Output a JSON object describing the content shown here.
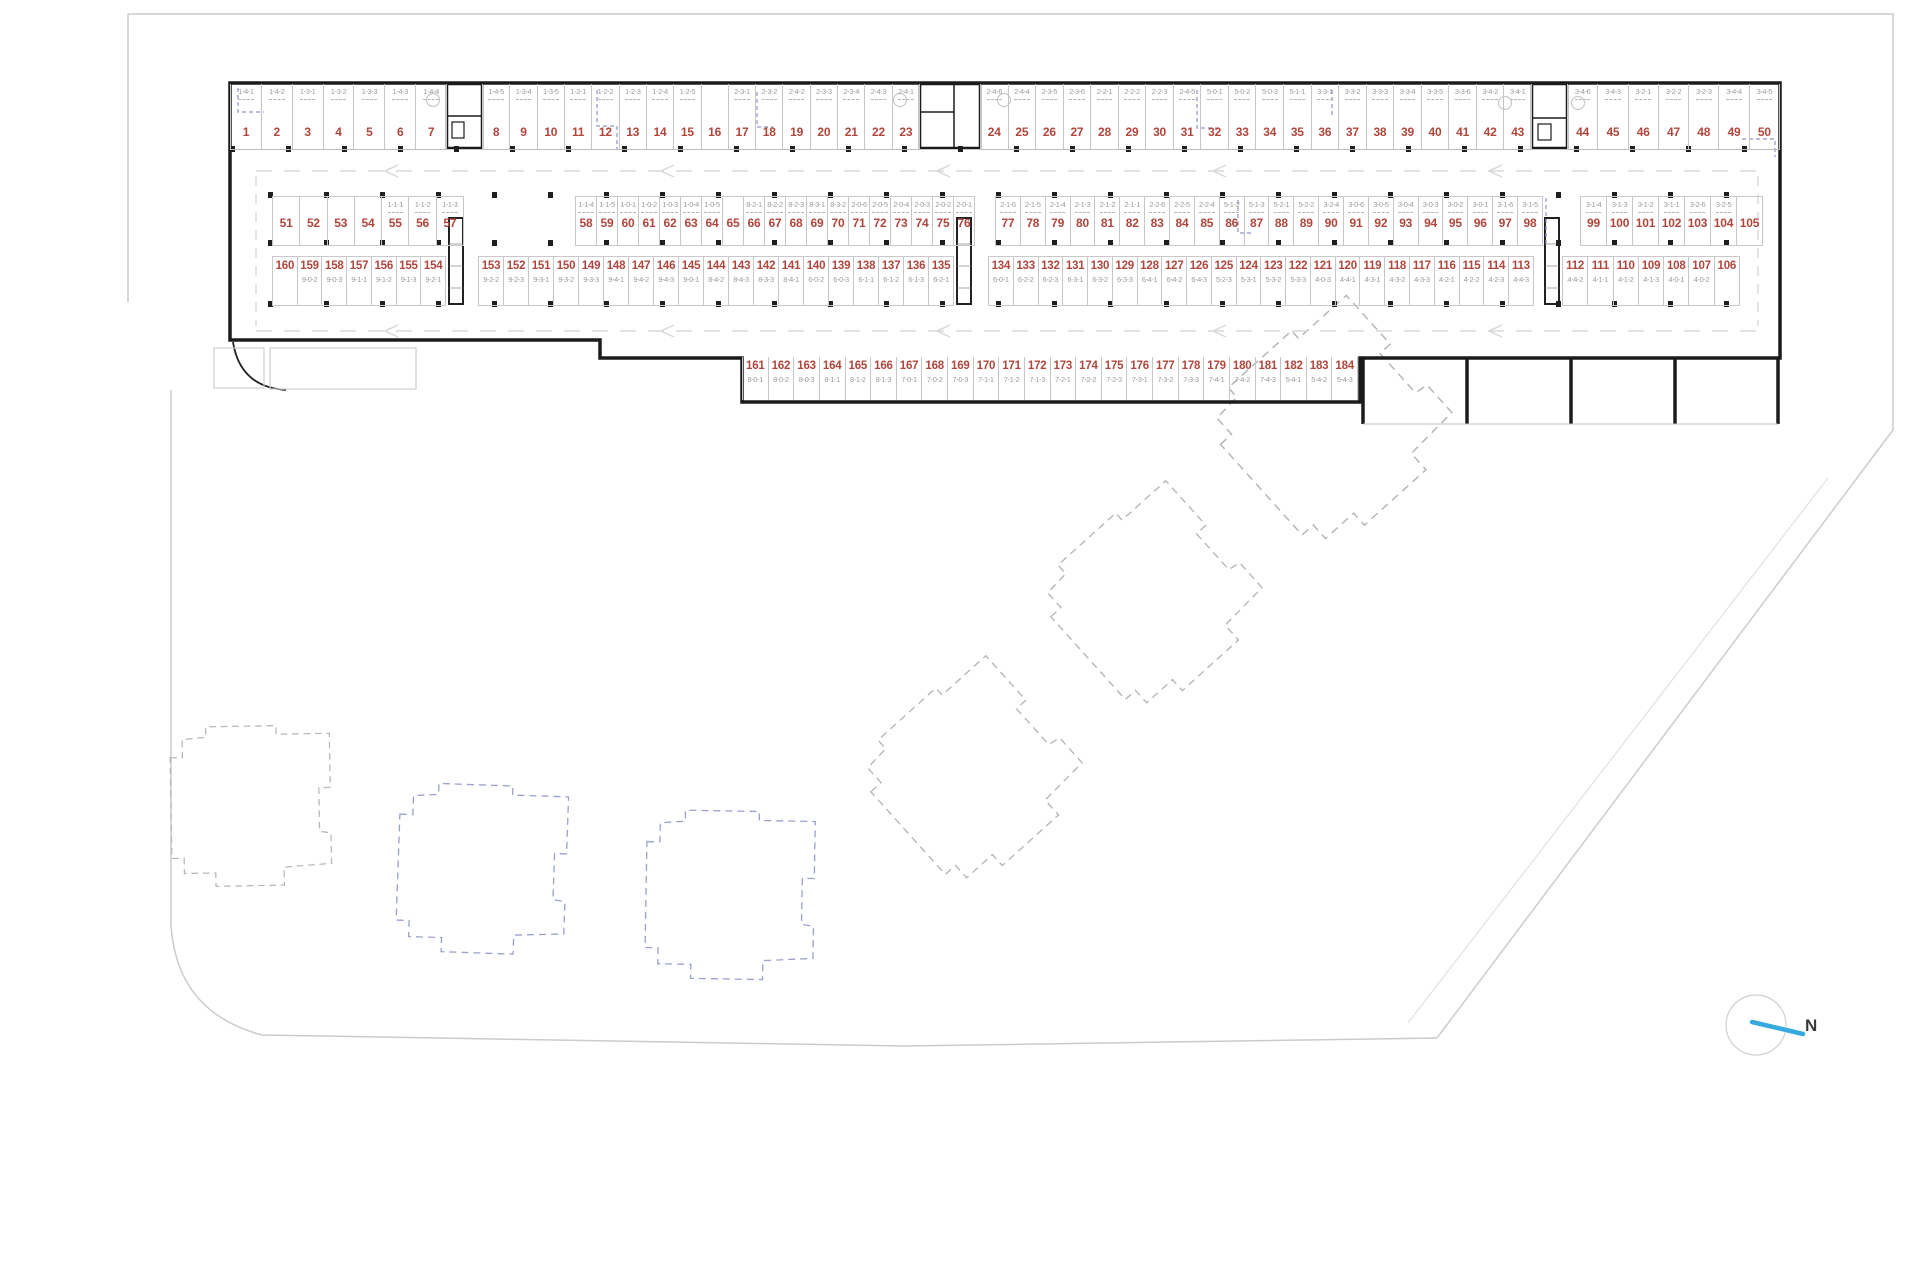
{
  "north": {
    "label": "N"
  },
  "colors": {
    "stall_number": "#b0463c",
    "stall_code": "#9c9c9c",
    "wall": "#1b1b1b",
    "divider": "#c6c6c6",
    "blue_accent": "#8d95c9",
    "building_dashed_gray": "#b6b6ba",
    "building_dashed_blue": "#99a1cd",
    "north_arrow": "#36a9e0"
  },
  "parking": {
    "rows": [
      {
        "name": "row-1",
        "code_position": "above",
        "groups": [
          {
            "stalls": [
              {
                "n": "1",
                "c": "1-4-1"
              },
              {
                "n": "2",
                "c": "1-4-2"
              },
              {
                "n": "3",
                "c": "1-3-1"
              },
              {
                "n": "4",
                "c": "1-3-2"
              },
              {
                "n": "5",
                "c": "1-3-3"
              },
              {
                "n": "6",
                "c": "1-4-3"
              },
              {
                "n": "7",
                "c": "1-4-4"
              }
            ]
          },
          {
            "stalls": [
              {
                "n": "8",
                "c": "1-4-5"
              },
              {
                "n": "9",
                "c": "1-3-4"
              },
              {
                "n": "10",
                "c": "1-3-5"
              },
              {
                "n": "11",
                "c": "1-2-1"
              },
              {
                "n": "12",
                "c": "1-2-2"
              },
              {
                "n": "13",
                "c": "1-2-3"
              },
              {
                "n": "14",
                "c": "1-2-4"
              },
              {
                "n": "15",
                "c": "1-2-5"
              },
              {
                "n": "16",
                "c": ""
              },
              {
                "n": "17",
                "c": "2-3-1"
              },
              {
                "n": "18",
                "c": "2-3-2"
              },
              {
                "n": "19",
                "c": "2-4-2"
              },
              {
                "n": "20",
                "c": "2-3-3"
              },
              {
                "n": "21",
                "c": "2-3-4"
              },
              {
                "n": "22",
                "c": "2-4-3"
              },
              {
                "n": "23",
                "c": "2-4-1"
              }
            ]
          },
          {
            "stalls": [
              {
                "n": "24",
                "c": "2-4-6"
              },
              {
                "n": "25",
                "c": "2-4-4"
              },
              {
                "n": "26",
                "c": "2-3-5"
              },
              {
                "n": "27",
                "c": "2-3-6"
              },
              {
                "n": "28",
                "c": "2-2-1"
              },
              {
                "n": "29",
                "c": "2-2-2"
              },
              {
                "n": "30",
                "c": "2-2-3"
              },
              {
                "n": "31",
                "c": "2-4-5"
              },
              {
                "n": "32",
                "c": "5-0-1"
              },
              {
                "n": "33",
                "c": "5-0-2"
              },
              {
                "n": "34",
                "c": "5-0-3"
              },
              {
                "n": "35",
                "c": "5-1-1"
              },
              {
                "n": "36",
                "c": "3-3-1"
              },
              {
                "n": "37",
                "c": "3-3-2"
              },
              {
                "n": "38",
                "c": "3-3-3"
              },
              {
                "n": "39",
                "c": "3-3-4"
              },
              {
                "n": "40",
                "c": "3-3-5"
              },
              {
                "n": "41",
                "c": "3-3-6"
              },
              {
                "n": "42",
                "c": "3-4-2"
              },
              {
                "n": "43",
                "c": "3-4-1"
              }
            ]
          },
          {
            "stalls": [
              {
                "n": "44",
                "c": "3-4-6"
              },
              {
                "n": "45",
                "c": "3-4-3"
              },
              {
                "n": "46",
                "c": "3-2-1"
              },
              {
                "n": "47",
                "c": "3-2-2"
              },
              {
                "n": "48",
                "c": "3-2-3"
              },
              {
                "n": "49",
                "c": "3-4-4"
              },
              {
                "n": "50",
                "c": "3-4-5"
              }
            ]
          }
        ]
      },
      {
        "name": "row-2",
        "code_position": "above",
        "groups": [
          {
            "stalls": [
              {
                "n": "51",
                "c": ""
              },
              {
                "n": "52",
                "c": ""
              },
              {
                "n": "53",
                "c": ""
              },
              {
                "n": "54",
                "c": ""
              },
              {
                "n": "55",
                "c": "1-1-1"
              },
              {
                "n": "56",
                "c": "1-1-2"
              },
              {
                "n": "57",
                "c": "1-1-3"
              }
            ]
          },
          {
            "stalls": [
              {
                "n": "58",
                "c": "1-1-4"
              },
              {
                "n": "59",
                "c": "1-1-5"
              },
              {
                "n": "60",
                "c": "1-0-1"
              },
              {
                "n": "61",
                "c": "1-0-2"
              },
              {
                "n": "62",
                "c": "1-0-3"
              },
              {
                "n": "63",
                "c": "1-0-4"
              },
              {
                "n": "64",
                "c": "1-0-5"
              },
              {
                "n": "65",
                "c": ""
              },
              {
                "n": "66",
                "c": "8-2-1"
              },
              {
                "n": "67",
                "c": "8-2-2"
              },
              {
                "n": "68",
                "c": "8-2-3"
              },
              {
                "n": "69",
                "c": "8-3-1"
              },
              {
                "n": "70",
                "c": "8-3-2"
              },
              {
                "n": "71",
                "c": "2-0-6"
              },
              {
                "n": "72",
                "c": "2-0-5"
              },
              {
                "n": "73",
                "c": "2-0-4"
              },
              {
                "n": "74",
                "c": "2-0-3"
              },
              {
                "n": "75",
                "c": "2-0-2"
              },
              {
                "n": "76",
                "c": "2-0-1"
              }
            ]
          },
          {
            "stalls": [
              {
                "n": "77",
                "c": "2-1-6"
              },
              {
                "n": "78",
                "c": "2-1-5"
              },
              {
                "n": "79",
                "c": "2-1-4"
              },
              {
                "n": "80",
                "c": "2-1-3"
              },
              {
                "n": "81",
                "c": "2-1-2"
              },
              {
                "n": "82",
                "c": "2-1-1"
              },
              {
                "n": "83",
                "c": "2-2-6"
              },
              {
                "n": "84",
                "c": "2-2-5"
              },
              {
                "n": "85",
                "c": "2-2-4"
              },
              {
                "n": "86",
                "c": "5-1-2"
              },
              {
                "n": "87",
                "c": "5-1-3"
              },
              {
                "n": "88",
                "c": "5-2-1"
              },
              {
                "n": "89",
                "c": "5-2-2"
              },
              {
                "n": "90",
                "c": "3-2-4"
              },
              {
                "n": "91",
                "c": "3-0-6"
              },
              {
                "n": "92",
                "c": "3-0-5"
              },
              {
                "n": "93",
                "c": "3-0-4"
              },
              {
                "n": "94",
                "c": "3-0-3"
              },
              {
                "n": "95",
                "c": "3-0-2"
              },
              {
                "n": "96",
                "c": "3-0-1"
              },
              {
                "n": "97",
                "c": "3-1-6"
              },
              {
                "n": "98",
                "c": "3-1-5"
              }
            ]
          },
          {
            "stalls": [
              {
                "n": "99",
                "c": "3-1-4"
              },
              {
                "n": "100",
                "c": "3-1-3"
              },
              {
                "n": "101",
                "c": "3-1-2"
              },
              {
                "n": "102",
                "c": "3-1-1"
              },
              {
                "n": "103",
                "c": "3-2-6"
              },
              {
                "n": "104",
                "c": "3-2-5"
              },
              {
                "n": "105",
                "c": ""
              }
            ]
          }
        ]
      },
      {
        "name": "row-3",
        "code_position": "below",
        "groups": [
          {
            "stalls": [
              {
                "n": "160",
                "c": ""
              },
              {
                "n": "159",
                "c": "9-0-2"
              },
              {
                "n": "158",
                "c": "9-0-3"
              },
              {
                "n": "157",
                "c": "9-1-1"
              },
              {
                "n": "156",
                "c": "9-1-2"
              },
              {
                "n": "155",
                "c": "9-1-3"
              },
              {
                "n": "154",
                "c": "9-2-1"
              }
            ]
          },
          {
            "stalls": [
              {
                "n": "153",
                "c": "9-2-2"
              },
              {
                "n": "152",
                "c": "9-2-3"
              },
              {
                "n": "151",
                "c": "9-3-1"
              },
              {
                "n": "150",
                "c": "9-3-2"
              },
              {
                "n": "149",
                "c": "9-3-3"
              },
              {
                "n": "148",
                "c": "9-4-1"
              },
              {
                "n": "147",
                "c": "9-4-2"
              },
              {
                "n": "146",
                "c": "9-4-3"
              },
              {
                "n": "145",
                "c": "9-0-1"
              },
              {
                "n": "144",
                "c": "8-4-2"
              },
              {
                "n": "143",
                "c": "8-4-3"
              },
              {
                "n": "142",
                "c": "8-3-3"
              },
              {
                "n": "141",
                "c": "8-4-1"
              },
              {
                "n": "140",
                "c": "6-0-2"
              },
              {
                "n": "139",
                "c": "6-0-3"
              },
              {
                "n": "138",
                "c": "6-1-1"
              },
              {
                "n": "137",
                "c": "6-1-2"
              },
              {
                "n": "136",
                "c": "6-1-3"
              },
              {
                "n": "135",
                "c": "6-2-1"
              }
            ]
          },
          {
            "stalls": [
              {
                "n": "134",
                "c": "6-0-1"
              },
              {
                "n": "133",
                "c": "6-2-2"
              },
              {
                "n": "132",
                "c": "6-2-3"
              },
              {
                "n": "131",
                "c": "6-3-1"
              },
              {
                "n": "130",
                "c": "6-3-2"
              },
              {
                "n": "129",
                "c": "6-3-3"
              },
              {
                "n": "128",
                "c": "6-4-1"
              },
              {
                "n": "127",
                "c": "6-4-2"
              },
              {
                "n": "126",
                "c": "6-4-3"
              },
              {
                "n": "125",
                "c": "5-2-3"
              },
              {
                "n": "124",
                "c": "5-3-1"
              },
              {
                "n": "123",
                "c": "5-3-2"
              },
              {
                "n": "122",
                "c": "5-3-3"
              },
              {
                "n": "121",
                "c": "4-0-3"
              },
              {
                "n": "120",
                "c": "4-4-1"
              },
              {
                "n": "119",
                "c": "4-3-1"
              },
              {
                "n": "118",
                "c": "4-3-2"
              },
              {
                "n": "117",
                "c": "4-3-3"
              },
              {
                "n": "116",
                "c": "4-2-1"
              },
              {
                "n": "115",
                "c": "4-2-2"
              },
              {
                "n": "114",
                "c": "4-2-3"
              },
              {
                "n": "113",
                "c": "4-4-3"
              }
            ]
          },
          {
            "stalls": [
              {
                "n": "112",
                "c": "4-4-2"
              },
              {
                "n": "111",
                "c": "4-1-1"
              },
              {
                "n": "110",
                "c": "4-1-2"
              },
              {
                "n": "109",
                "c": "4-1-3"
              },
              {
                "n": "108",
                "c": "4-0-1"
              },
              {
                "n": "107",
                "c": "4-0-2"
              },
              {
                "n": "106",
                "c": ""
              }
            ]
          }
        ]
      },
      {
        "name": "row-4",
        "code_position": "below",
        "groups": [
          {
            "stalls": [
              {
                "n": "161",
                "c": "8-0-1"
              },
              {
                "n": "162",
                "c": "8-0-2"
              },
              {
                "n": "163",
                "c": "8-0-3"
              },
              {
                "n": "164",
                "c": "8-1-1"
              },
              {
                "n": "165",
                "c": "8-1-2"
              },
              {
                "n": "166",
                "c": "8-1-3"
              },
              {
                "n": "167",
                "c": "7-0-1"
              },
              {
                "n": "168",
                "c": "7-0-2"
              },
              {
                "n": "169",
                "c": "7-0-3"
              },
              {
                "n": "170",
                "c": "7-1-1"
              },
              {
                "n": "171",
                "c": "7-1-2"
              },
              {
                "n": "172",
                "c": "7-1-3"
              },
              {
                "n": "173",
                "c": "7-2-1"
              },
              {
                "n": "174",
                "c": "7-2-2"
              },
              {
                "n": "175",
                "c": "7-2-3"
              },
              {
                "n": "176",
                "c": "7-3-1"
              },
              {
                "n": "177",
                "c": "7-3-2"
              },
              {
                "n": "178",
                "c": "7-3-3"
              },
              {
                "n": "179",
                "c": "7-4-1"
              },
              {
                "n": "180",
                "c": "7-4-2"
              },
              {
                "n": "181",
                "c": "7-4-3"
              },
              {
                "n": "182",
                "c": "5-4-1"
              },
              {
                "n": "183",
                "c": "5-4-2"
              },
              {
                "n": "184",
                "c": "5-4-3"
              }
            ]
          }
        ]
      }
    ]
  }
}
